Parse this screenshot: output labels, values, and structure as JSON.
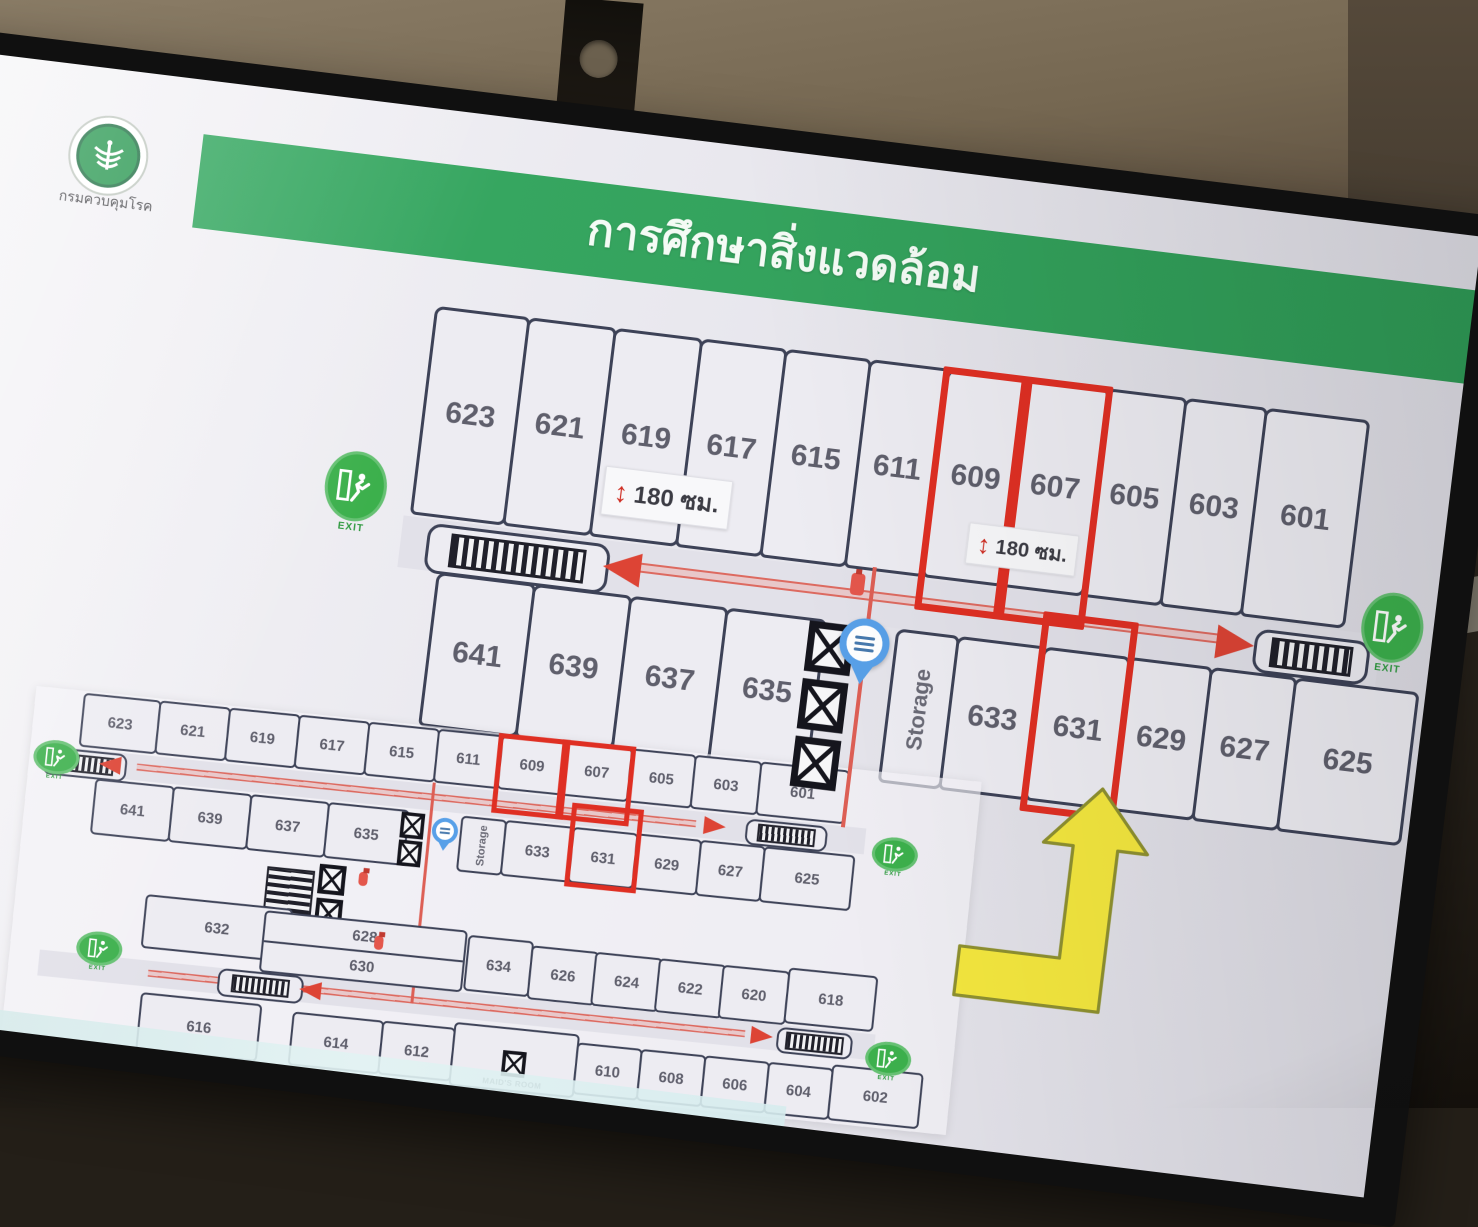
{
  "slide": {
    "title": "การศึกษาสิ่งแวดล้อม",
    "org_name": "กรมควบคุมโรค"
  },
  "labels": {
    "exit": "EXIT",
    "clearance": "180 ซม.",
    "storage": "Storage",
    "maids_room": "MAID'S ROOM"
  },
  "colors": {
    "banner_green": "#35a55e",
    "exit_green": "#3cb04c",
    "highlight_red": "#df2f23",
    "path_red": "#dd5f55",
    "arrow_yellow": "#f3e63e",
    "wall_navy": "#3d4257",
    "pin_blue": "#58a0e8"
  },
  "main_plan": {
    "top_row": [
      "623",
      "621",
      "619",
      "617",
      "615",
      "611",
      "609",
      "607",
      "605",
      "603",
      "601"
    ],
    "bottom_left": [
      "641",
      "639",
      "637",
      "635"
    ],
    "bottom_right": [
      "633",
      "631",
      "629",
      "627",
      "625"
    ],
    "highlighted": [
      "609",
      "607",
      "631"
    ]
  },
  "small_plan": {
    "row_a": [
      "623",
      "621",
      "619",
      "617",
      "615",
      "611",
      "609",
      "607",
      "605",
      "603",
      "601"
    ],
    "row_b_left": [
      "641",
      "639",
      "637",
      "635"
    ],
    "row_b_right": [
      "633",
      "631",
      "629",
      "627",
      "625"
    ],
    "row_c": [
      "632",
      "628",
      "630",
      "634",
      "626",
      "624",
      "622",
      "620",
      "618"
    ],
    "row_d": [
      "616",
      "614",
      "612",
      "610",
      "608",
      "606",
      "604",
      "602"
    ]
  }
}
